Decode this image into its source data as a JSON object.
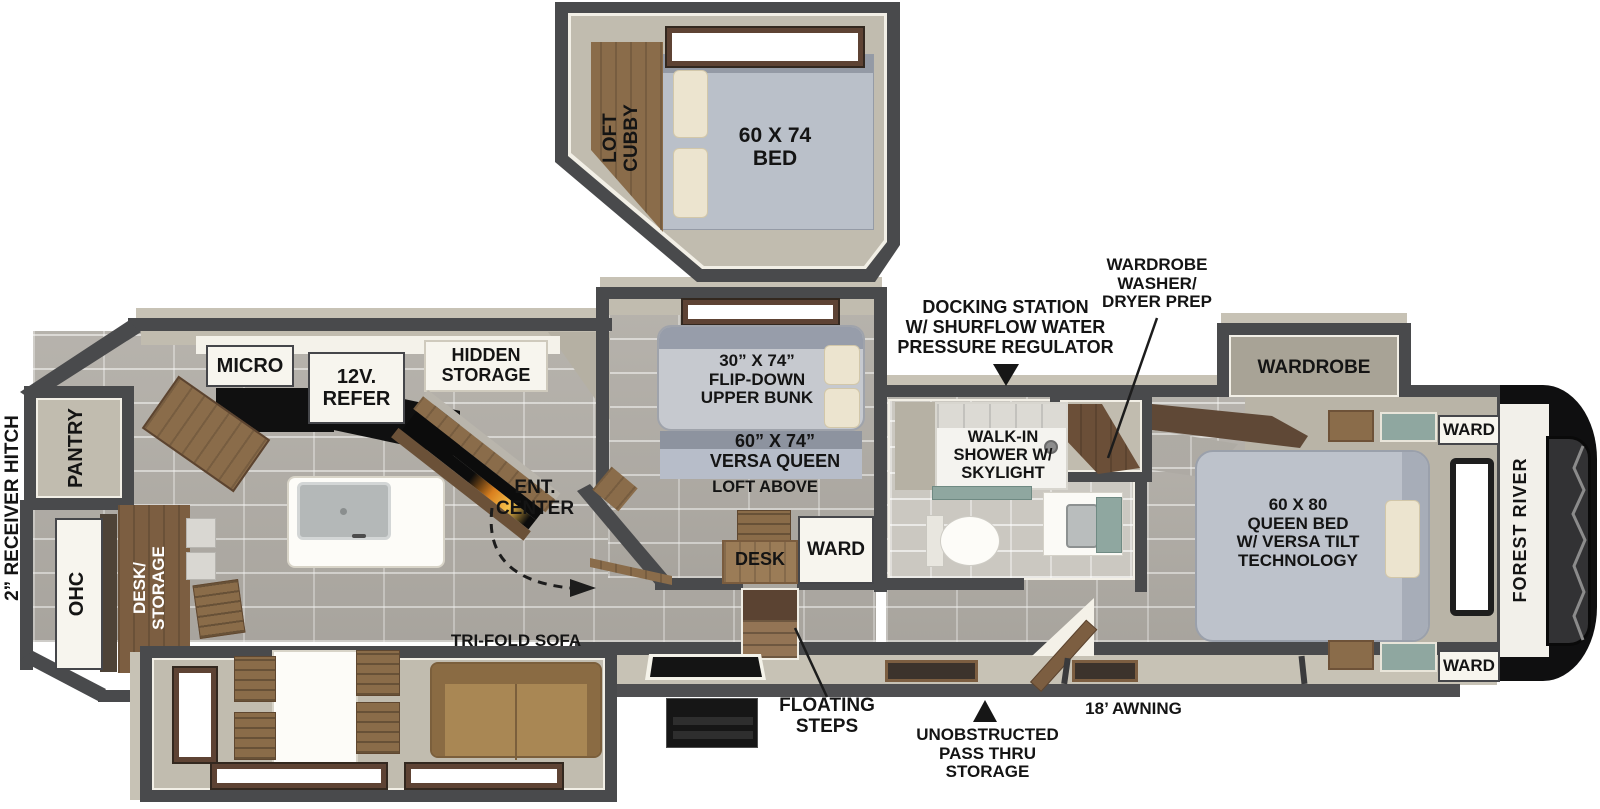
{
  "brand": "FOREST RIVER",
  "colors": {
    "wall": "#494a4c",
    "floor": "#b1ada6",
    "interior": "#c1bcaf",
    "exterior_band": "#c7c2b5",
    "wood": "#8a6c4a",
    "wood_dark": "#5f4836",
    "mattress": "#bdc2cb",
    "pillow": "#ece4cf",
    "teal_accent": "#8fa7a0",
    "sofa": "#9b7a4f",
    "label_text": "#141414",
    "cap_black": "#0f0f10"
  },
  "loft": {
    "cubby_lines": [
      "LOFT",
      "CUBBY"
    ],
    "bed_lines": [
      "60 X 74",
      "BED"
    ]
  },
  "bunk_room": {
    "upper_bunk_lines": [
      "30” X 74”",
      "FLIP-DOWN",
      "UPPER BUNK"
    ],
    "versa_queen_lines": [
      "60” X 74”",
      "VERSA QUEEN"
    ],
    "loft_above": "LOFT ABOVE",
    "desk": "DESK",
    "ward": "WARD"
  },
  "kitchen": {
    "micro": "MICRO",
    "refer_lines": [
      "12V.",
      "REFER"
    ],
    "hidden_storage_lines": [
      "HIDDEN",
      "STORAGE"
    ],
    "ent_center_lines": [
      "ENT.",
      "CENTER"
    ]
  },
  "rear": {
    "receiver_hitch": "2” RECEIVER HITCH",
    "pantry": "PANTRY",
    "ohc": "OHC",
    "desk_storage_lines": [
      "DESK/",
      "STORAGE"
    ]
  },
  "living": {
    "sofa": "TRI-FOLD SOFA"
  },
  "bathroom": {
    "shower_lines": [
      "WALK-IN",
      "SHOWER W/",
      "SKYLIGHT"
    ]
  },
  "bedroom": {
    "wardrobe": "WARDROBE",
    "bed_lines": [
      "60 X 80",
      "QUEEN BED",
      "W/ VERSA TILT",
      "TECHNOLOGY"
    ],
    "ward_top": "WARD",
    "ward_bottom": "WARD"
  },
  "callouts": {
    "docking_lines": [
      "DOCKING STATION",
      "W/ SHURFLOW WATER",
      "PRESSURE REGULATOR"
    ],
    "wd_prep_lines": [
      "WARDROBE",
      "WASHER/",
      "DRYER PREP"
    ],
    "floating_steps_lines": [
      "FLOATING",
      "STEPS"
    ],
    "pass_thru_lines": [
      "UNOBSTRUCTED",
      "PASS THRU",
      "STORAGE"
    ],
    "awning": "18’ AWNING"
  }
}
